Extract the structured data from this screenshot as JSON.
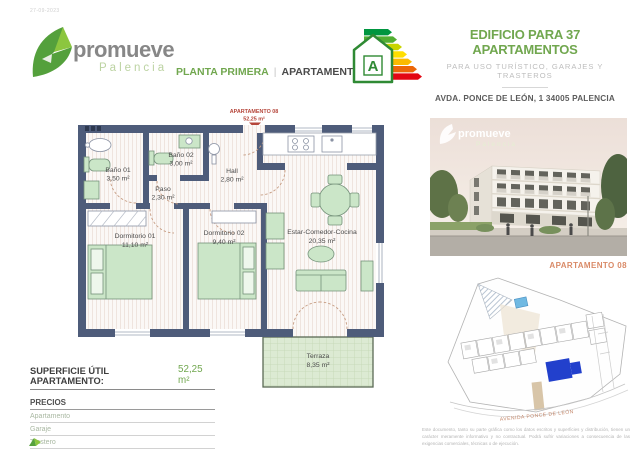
{
  "meta": {
    "date": "27-09-2023"
  },
  "logo": {
    "name": "promueve",
    "sub": "Palencia"
  },
  "header": {
    "plan_label": "PLANTA PRIMERA",
    "separator": "|",
    "apartment_label": "APARTAMENTO 08",
    "title": "EDIFICIO PARA 37 APARTAMENTOS",
    "subtitle": "PARA USO TURÍSTICO, GARAJES Y TRASTEROS",
    "address": "AVDA. PONCE DE LEÓN, 1 34005 PALENCIA",
    "energy_rating": "A"
  },
  "floorplan": {
    "entrance_label": "APARTAMENTO 08",
    "entrance_area": "52,25 m²",
    "rooms": [
      {
        "name": "Baño 01",
        "area": "3,50 m²"
      },
      {
        "name": "Baño 02",
        "area": "3,00 m²"
      },
      {
        "name": "Paso",
        "area": "2,30 m²"
      },
      {
        "name": "Hall",
        "area": "2,80 m²"
      },
      {
        "name": "Dormitorio 01",
        "area": "11,10 m²"
      },
      {
        "name": "Dormitorio 02",
        "area": "9,40 m²"
      },
      {
        "name": "Estar-Comedor-Cocina",
        "area": "20,35 m²"
      },
      {
        "name": "Terraza",
        "area": "8,35 m²"
      }
    ]
  },
  "summary": {
    "surface_label": "SUPERFICIE ÚTIL APARTAMENTO:",
    "surface_value": "52,25 m²",
    "prices_title": "PRECIOS",
    "price_rows": [
      "Apartamento",
      "Garaje",
      "Trastero"
    ],
    "price_note": "Sobre los importes indicados se aplicará el IVA correspondiente"
  },
  "sidebar": {
    "render_watermark": "promueve",
    "render_watermark_sub": "Palencia",
    "siteplan_label": "APARTAMENTO 08",
    "street_label": "AVENIDA PONCE DE LEÓN",
    "disclaimer": "Este documento, tanto su parte gráfica como los datos escritos y superficies y distribución, tienen un carácter meramente informativo y no contractual. Podrá sufrir variaciones a consecuencia de las exigencias comerciales, técnicas o de ejecución."
  },
  "colors": {
    "accent_green": "#71a74f",
    "wall_blue": "#4e5c7a",
    "furniture_green": "#cbe6c8",
    "highlight_blue": "#2240cc",
    "entrance_red": "#b5453a",
    "site_label_orange": "#d98a67"
  }
}
